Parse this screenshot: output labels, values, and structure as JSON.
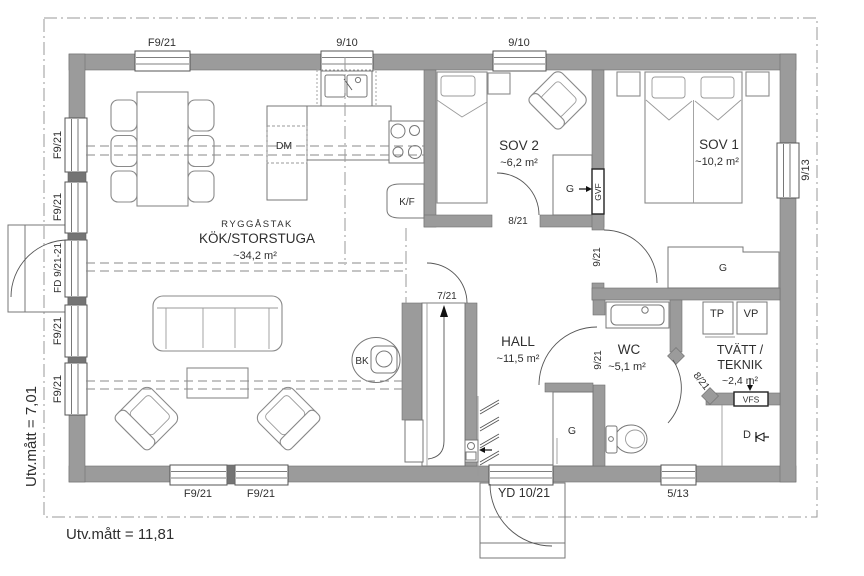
{
  "plan": {
    "outer_width_label": "Utv.mått = 11,81",
    "outer_height_label": "Utv.mått = 7,01"
  },
  "rooms": {
    "kitchen_ceiling": "RYGGÅSTAK",
    "kitchen_name": "KÖK/STORSTUGA",
    "kitchen_area": "~34,2 m²",
    "sov1_name": "SOV 1",
    "sov1_area": "~10,2 m²",
    "sov2_name": "SOV 2",
    "sov2_area": "~6,2 m²",
    "hall_name": "HALL",
    "hall_area": "~11,5 m²",
    "wc_name": "WC",
    "wc_area": "~5,1 m²",
    "laundry_name_line1": "TVÄTT /",
    "laundry_name_line2": "TEKNIK",
    "laundry_area": "~2,4 m²"
  },
  "openings": {
    "window_f921": "F9/21",
    "window_910": "9/10",
    "window_913": "9/13",
    "window_513": "5/13",
    "entry_door_fd": "FD 9/21-21",
    "entry_door_yd": "YD 10/21",
    "door_721": "7/21",
    "door_821": "8/21",
    "door_921": "9/21"
  },
  "fixtures": {
    "dishwasher": "DM",
    "fridge_freezer": "K/F",
    "stove_bk": "BK",
    "wardrobe": "G",
    "gvf": "GVF",
    "vfs": "VFS",
    "tp": "TP",
    "vp": "VP",
    "drain": "D"
  },
  "colors": {
    "wall": "#9b9b9b",
    "wall_dark": "#747474",
    "outline": "#6e6e6e",
    "furniture_line": "#8a8a8a",
    "text": "#2f2f2f",
    "background": "#ffffff"
  }
}
